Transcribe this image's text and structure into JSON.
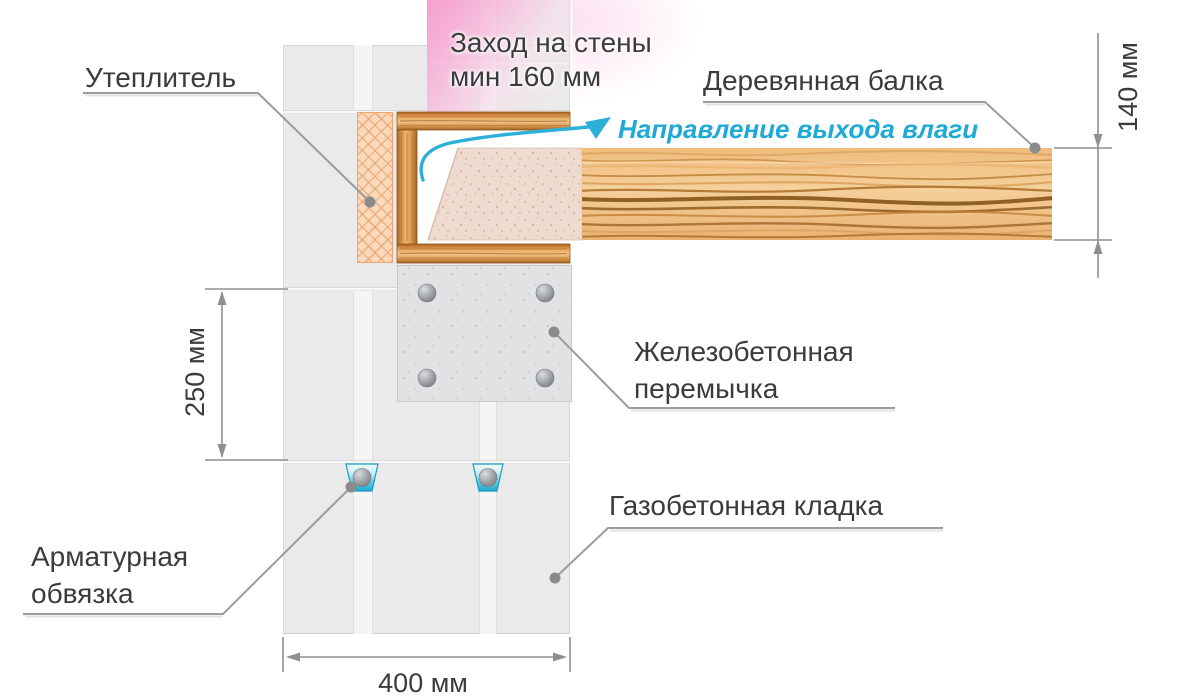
{
  "diagram": {
    "note": {
      "line1": "Заход на стены",
      "line2": "мин 160 мм"
    },
    "labels": {
      "insulation": "Утеплитель",
      "wooden_beam": "Деревянная балка",
      "moisture_direction": "Направление выхода влаги",
      "concrete_lintel_line1": "Железобетонная",
      "concrete_lintel_line2": "перемычка",
      "masonry": "Газобетонная кладка",
      "rebar_tie_line1": "Арматурная",
      "rebar_tie_line2": "обвязка"
    },
    "dimensions": {
      "beam_height": "140 мм",
      "course_height": "250 мм",
      "wall_thickness": "400 мм"
    },
    "colors": {
      "highlight_pink": "#f69acb",
      "moisture_cyan": "#2cb0da",
      "wood_light": "#f3c083",
      "wood_dark": "#8a5517",
      "masonry_gray": "#eaeaea",
      "lintel_gray": "#e0e2e4",
      "insulation_peach": "#fbd9ba",
      "line_gray": "#9c9c9c",
      "text_dark": "#3b3b3d"
    }
  }
}
